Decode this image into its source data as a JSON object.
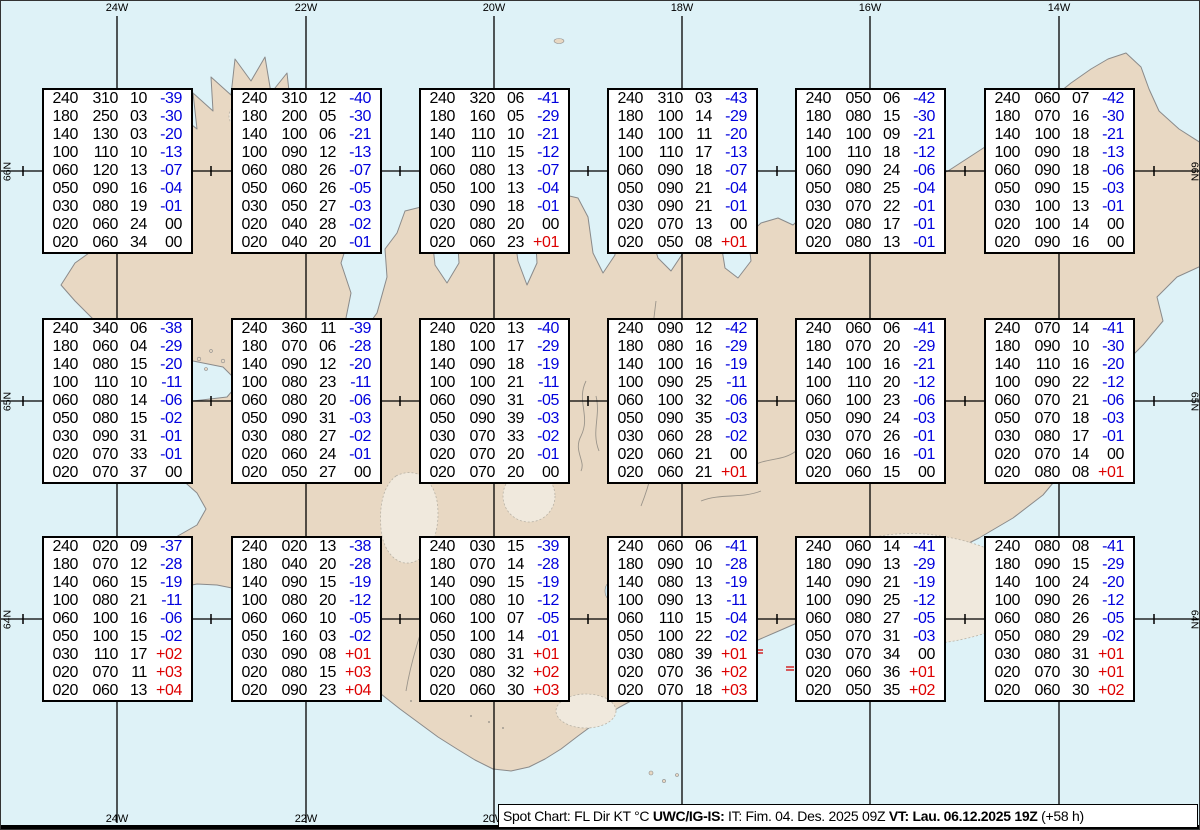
{
  "map": {
    "meridian_labels": [
      "24W",
      "22W",
      "20W",
      "18W",
      "16W",
      "14W"
    ],
    "meridian_x": [
      116,
      305,
      493,
      681,
      869,
      1058
    ],
    "latitude_labels": [
      "66N",
      "65N",
      "64N"
    ],
    "latitude_y": [
      170,
      400,
      618
    ]
  },
  "legend": {
    "part1": "Spot Chart: FL Dir KT °C ",
    "part2": "UWC/IG-IS:",
    "part3": " IT: Fim. 04. Des. 2025 09Z ",
    "part4": "VT: Lau. 06.12.2025 19Z",
    "part5": " (+58 h)",
    "columns": [
      "FL",
      "Dir",
      "KT",
      "°C"
    ]
  },
  "colors": {
    "ocean": "#def2f7",
    "land": "#e8d8c3",
    "glacier": "#f0e9dd",
    "lake": "#cfe6ee",
    "grid": "#000000",
    "temp_negative": "#0000dd",
    "temp_positive": "#dd0000",
    "temp_zero": "#000000"
  },
  "boxes": [
    {
      "row": 0,
      "col": 0,
      "rows": [
        [
          "240",
          "310",
          "10",
          "-39"
        ],
        [
          "180",
          "250",
          "03",
          "-30"
        ],
        [
          "140",
          "130",
          "03",
          "-20"
        ],
        [
          "100",
          "110",
          "10",
          "-13"
        ],
        [
          "060",
          "120",
          "13",
          "-07"
        ],
        [
          "050",
          "090",
          "16",
          "-04"
        ],
        [
          "030",
          "080",
          "19",
          "-01"
        ],
        [
          "020",
          "060",
          "24",
          "00"
        ],
        [
          "020",
          "060",
          "34",
          "00"
        ]
      ]
    },
    {
      "row": 0,
      "col": 1,
      "rows": [
        [
          "240",
          "310",
          "12",
          "-40"
        ],
        [
          "180",
          "200",
          "05",
          "-30"
        ],
        [
          "140",
          "100",
          "06",
          "-21"
        ],
        [
          "100",
          "090",
          "12",
          "-13"
        ],
        [
          "060",
          "080",
          "26",
          "-07"
        ],
        [
          "050",
          "060",
          "26",
          "-05"
        ],
        [
          "030",
          "050",
          "27",
          "-03"
        ],
        [
          "020",
          "040",
          "28",
          "-02"
        ],
        [
          "020",
          "040",
          "20",
          "-01"
        ]
      ]
    },
    {
      "row": 0,
      "col": 2,
      "rows": [
        [
          "240",
          "320",
          "06",
          "-41"
        ],
        [
          "180",
          "160",
          "05",
          "-29"
        ],
        [
          "140",
          "110",
          "10",
          "-21"
        ],
        [
          "100",
          "110",
          "15",
          "-12"
        ],
        [
          "060",
          "080",
          "13",
          "-07"
        ],
        [
          "050",
          "100",
          "13",
          "-04"
        ],
        [
          "030",
          "090",
          "18",
          "-01"
        ],
        [
          "020",
          "080",
          "20",
          "00"
        ],
        [
          "020",
          "060",
          "23",
          "+01"
        ]
      ]
    },
    {
      "row": 0,
      "col": 3,
      "rows": [
        [
          "240",
          "310",
          "03",
          "-43"
        ],
        [
          "180",
          "100",
          "14",
          "-29"
        ],
        [
          "140",
          "100",
          "11",
          "-20"
        ],
        [
          "100",
          "110",
          "17",
          "-13"
        ],
        [
          "060",
          "090",
          "18",
          "-07"
        ],
        [
          "050",
          "090",
          "21",
          "-04"
        ],
        [
          "030",
          "090",
          "21",
          "-01"
        ],
        [
          "020",
          "070",
          "13",
          "00"
        ],
        [
          "020",
          "050",
          "08",
          "+01"
        ]
      ]
    },
    {
      "row": 0,
      "col": 4,
      "rows": [
        [
          "240",
          "050",
          "06",
          "-42"
        ],
        [
          "180",
          "080",
          "15",
          "-30"
        ],
        [
          "140",
          "100",
          "09",
          "-21"
        ],
        [
          "100",
          "110",
          "18",
          "-12"
        ],
        [
          "060",
          "090",
          "24",
          "-06"
        ],
        [
          "050",
          "080",
          "25",
          "-04"
        ],
        [
          "030",
          "070",
          "22",
          "-01"
        ],
        [
          "020",
          "080",
          "17",
          "-01"
        ],
        [
          "020",
          "080",
          "13",
          "-01"
        ]
      ]
    },
    {
      "row": 0,
      "col": 5,
      "rows": [
        [
          "240",
          "060",
          "07",
          "-42"
        ],
        [
          "180",
          "070",
          "16",
          "-30"
        ],
        [
          "140",
          "100",
          "18",
          "-21"
        ],
        [
          "100",
          "090",
          "18",
          "-13"
        ],
        [
          "060",
          "090",
          "18",
          "-06"
        ],
        [
          "050",
          "090",
          "15",
          "-03"
        ],
        [
          "030",
          "100",
          "13",
          "-01"
        ],
        [
          "020",
          "100",
          "14",
          "00"
        ],
        [
          "020",
          "090",
          "16",
          "00"
        ]
      ]
    },
    {
      "row": 1,
      "col": 0,
      "rows": [
        [
          "240",
          "340",
          "06",
          "-38"
        ],
        [
          "180",
          "060",
          "04",
          "-29"
        ],
        [
          "140",
          "080",
          "15",
          "-20"
        ],
        [
          "100",
          "110",
          "10",
          "-11"
        ],
        [
          "060",
          "080",
          "14",
          "-06"
        ],
        [
          "050",
          "080",
          "15",
          "-02"
        ],
        [
          "030",
          "090",
          "31",
          "-01"
        ],
        [
          "020",
          "070",
          "33",
          "-01"
        ],
        [
          "020",
          "070",
          "37",
          "00"
        ]
      ]
    },
    {
      "row": 1,
      "col": 1,
      "rows": [
        [
          "240",
          "360",
          "11",
          "-39"
        ],
        [
          "180",
          "070",
          "06",
          "-28"
        ],
        [
          "140",
          "090",
          "12",
          "-20"
        ],
        [
          "100",
          "080",
          "23",
          "-11"
        ],
        [
          "060",
          "080",
          "20",
          "-06"
        ],
        [
          "050",
          "090",
          "31",
          "-03"
        ],
        [
          "030",
          "080",
          "27",
          "-02"
        ],
        [
          "020",
          "060",
          "24",
          "-01"
        ],
        [
          "020",
          "050",
          "27",
          "00"
        ]
      ]
    },
    {
      "row": 1,
      "col": 2,
      "rows": [
        [
          "240",
          "020",
          "13",
          "-40"
        ],
        [
          "180",
          "100",
          "17",
          "-29"
        ],
        [
          "140",
          "090",
          "18",
          "-19"
        ],
        [
          "100",
          "100",
          "21",
          "-11"
        ],
        [
          "060",
          "090",
          "31",
          "-05"
        ],
        [
          "050",
          "090",
          "39",
          "-03"
        ],
        [
          "030",
          "070",
          "33",
          "-02"
        ],
        [
          "020",
          "070",
          "20",
          "-01"
        ],
        [
          "020",
          "070",
          "20",
          "00"
        ]
      ]
    },
    {
      "row": 1,
      "col": 3,
      "rows": [
        [
          "240",
          "090",
          "12",
          "-42"
        ],
        [
          "180",
          "080",
          "16",
          "-29"
        ],
        [
          "140",
          "100",
          "16",
          "-19"
        ],
        [
          "100",
          "090",
          "25",
          "-11"
        ],
        [
          "060",
          "100",
          "32",
          "-06"
        ],
        [
          "050",
          "090",
          "35",
          "-03"
        ],
        [
          "030",
          "060",
          "28",
          "-02"
        ],
        [
          "020",
          "060",
          "21",
          "00"
        ],
        [
          "020",
          "060",
          "21",
          "+01"
        ]
      ]
    },
    {
      "row": 1,
      "col": 4,
      "rows": [
        [
          "240",
          "060",
          "06",
          "-41"
        ],
        [
          "180",
          "070",
          "20",
          "-29"
        ],
        [
          "140",
          "100",
          "16",
          "-21"
        ],
        [
          "100",
          "110",
          "20",
          "-12"
        ],
        [
          "060",
          "100",
          "23",
          "-06"
        ],
        [
          "050",
          "090",
          "24",
          "-03"
        ],
        [
          "030",
          "070",
          "26",
          "-01"
        ],
        [
          "020",
          "060",
          "16",
          "-01"
        ],
        [
          "020",
          "060",
          "15",
          "00"
        ]
      ]
    },
    {
      "row": 1,
      "col": 5,
      "rows": [
        [
          "240",
          "070",
          "14",
          "-41"
        ],
        [
          "180",
          "090",
          "10",
          "-30"
        ],
        [
          "140",
          "110",
          "16",
          "-20"
        ],
        [
          "100",
          "090",
          "22",
          "-12"
        ],
        [
          "060",
          "070",
          "21",
          "-06"
        ],
        [
          "050",
          "070",
          "18",
          "-03"
        ],
        [
          "030",
          "080",
          "17",
          "-01"
        ],
        [
          "020",
          "070",
          "14",
          "00"
        ],
        [
          "020",
          "080",
          "08",
          "+01"
        ]
      ]
    },
    {
      "row": 2,
      "col": 0,
      "rows": [
        [
          "240",
          "020",
          "09",
          "-37"
        ],
        [
          "180",
          "070",
          "12",
          "-28"
        ],
        [
          "140",
          "060",
          "15",
          "-19"
        ],
        [
          "100",
          "080",
          "21",
          "-11"
        ],
        [
          "060",
          "100",
          "16",
          "-06"
        ],
        [
          "050",
          "100",
          "15",
          "-02"
        ],
        [
          "030",
          "110",
          "17",
          "+02"
        ],
        [
          "020",
          "070",
          "11",
          "+03"
        ],
        [
          "020",
          "060",
          "13",
          "+04"
        ]
      ]
    },
    {
      "row": 2,
      "col": 1,
      "rows": [
        [
          "240",
          "020",
          "13",
          "-38"
        ],
        [
          "180",
          "040",
          "20",
          "-28"
        ],
        [
          "140",
          "090",
          "15",
          "-19"
        ],
        [
          "100",
          "080",
          "20",
          "-12"
        ],
        [
          "060",
          "060",
          "10",
          "-05"
        ],
        [
          "050",
          "160",
          "03",
          "-02"
        ],
        [
          "030",
          "090",
          "08",
          "+01"
        ],
        [
          "020",
          "080",
          "15",
          "+03"
        ],
        [
          "020",
          "090",
          "23",
          "+04"
        ]
      ]
    },
    {
      "row": 2,
      "col": 2,
      "rows": [
        [
          "240",
          "030",
          "15",
          "-39"
        ],
        [
          "180",
          "070",
          "14",
          "-28"
        ],
        [
          "140",
          "090",
          "15",
          "-19"
        ],
        [
          "100",
          "080",
          "10",
          "-12"
        ],
        [
          "060",
          "100",
          "07",
          "-05"
        ],
        [
          "050",
          "100",
          "14",
          "-01"
        ],
        [
          "030",
          "080",
          "31",
          "+01"
        ],
        [
          "020",
          "080",
          "32",
          "+02"
        ],
        [
          "020",
          "060",
          "30",
          "+03"
        ]
      ]
    },
    {
      "row": 2,
      "col": 3,
      "rows": [
        [
          "240",
          "060",
          "06",
          "-41"
        ],
        [
          "180",
          "090",
          "10",
          "-28"
        ],
        [
          "140",
          "080",
          "13",
          "-19"
        ],
        [
          "100",
          "090",
          "13",
          "-11"
        ],
        [
          "060",
          "110",
          "15",
          "-04"
        ],
        [
          "050",
          "100",
          "22",
          "-02"
        ],
        [
          "030",
          "080",
          "39",
          "+01"
        ],
        [
          "020",
          "070",
          "36",
          "+02"
        ],
        [
          "020",
          "070",
          "18",
          "+03"
        ]
      ]
    },
    {
      "row": 2,
      "col": 4,
      "rows": [
        [
          "240",
          "060",
          "14",
          "-41"
        ],
        [
          "180",
          "090",
          "13",
          "-29"
        ],
        [
          "140",
          "090",
          "21",
          "-19"
        ],
        [
          "100",
          "090",
          "25",
          "-12"
        ],
        [
          "060",
          "080",
          "27",
          "-05"
        ],
        [
          "050",
          "070",
          "31",
          "-03"
        ],
        [
          "030",
          "070",
          "34",
          "00"
        ],
        [
          "020",
          "060",
          "36",
          "+01"
        ],
        [
          "020",
          "050",
          "35",
          "+02"
        ]
      ]
    },
    {
      "row": 2,
      "col": 5,
      "rows": [
        [
          "240",
          "080",
          "08",
          "-41"
        ],
        [
          "180",
          "090",
          "15",
          "-29"
        ],
        [
          "140",
          "100",
          "24",
          "-20"
        ],
        [
          "100",
          "090",
          "26",
          "-12"
        ],
        [
          "060",
          "080",
          "26",
          "-05"
        ],
        [
          "050",
          "080",
          "29",
          "-02"
        ],
        [
          "030",
          "080",
          "31",
          "+01"
        ],
        [
          "020",
          "070",
          "30",
          "+01"
        ],
        [
          "020",
          "060",
          "30",
          "+02"
        ]
      ]
    }
  ]
}
